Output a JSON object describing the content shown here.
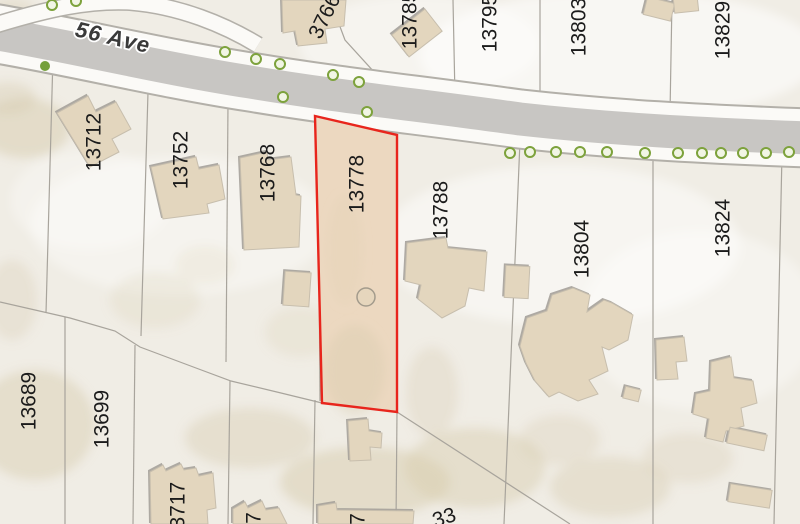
{
  "map": {
    "type": "parcel-map",
    "street": {
      "name": "56 Ave"
    },
    "selected_parcel": {
      "number": "13778",
      "outline_color": "#e8251c",
      "fill_color": "#ecd8c0"
    },
    "labels": [
      {
        "id": "street-56-ave",
        "text": "56 Ave",
        "x": 113,
        "y": 37,
        "rot": 13,
        "kind": "street"
      },
      {
        "id": "3766",
        "text": "3766",
        "x": 324,
        "y": 16,
        "rot": -64,
        "kind": "parcel"
      },
      {
        "id": "13785",
        "text": "13785",
        "x": 409,
        "y": 20,
        "rot": -90,
        "kind": "parcel"
      },
      {
        "id": "13795",
        "text": "13795",
        "x": 489,
        "y": 23,
        "rot": -90,
        "kind": "parcel"
      },
      {
        "id": "13803",
        "text": "13803",
        "x": 578,
        "y": 27,
        "rot": -90,
        "kind": "parcel"
      },
      {
        "id": "13829",
        "text": "13829",
        "x": 722,
        "y": 30,
        "rot": -90,
        "kind": "parcel"
      },
      {
        "id": "13712",
        "text": "13712",
        "x": 93,
        "y": 142,
        "rot": -90,
        "kind": "parcel"
      },
      {
        "id": "13752",
        "text": "13752",
        "x": 180,
        "y": 160,
        "rot": -90,
        "kind": "parcel"
      },
      {
        "id": "13768",
        "text": "13768",
        "x": 267,
        "y": 173,
        "rot": -90,
        "kind": "parcel"
      },
      {
        "id": "13778",
        "text": "13778",
        "x": 356,
        "y": 184,
        "rot": -90,
        "kind": "parcel",
        "selected": true
      },
      {
        "id": "13788",
        "text": "13788",
        "x": 440,
        "y": 210,
        "rot": -90,
        "kind": "parcel"
      },
      {
        "id": "13804",
        "text": "13804",
        "x": 581,
        "y": 249,
        "rot": -90,
        "kind": "parcel"
      },
      {
        "id": "13824",
        "text": "13824",
        "x": 722,
        "y": 228,
        "rot": -90,
        "kind": "parcel"
      },
      {
        "id": "13689",
        "text": "13689",
        "x": 28,
        "y": 401,
        "rot": -90,
        "kind": "parcel"
      },
      {
        "id": "13699",
        "text": "13699",
        "x": 101,
        "y": 419,
        "rot": -90,
        "kind": "parcel"
      },
      {
        "id": "13717",
        "text": "13717",
        "x": 177,
        "y": 511,
        "rot": -90,
        "kind": "parcel"
      },
      {
        "id": "partial-7-left",
        "text": "7",
        "x": 253,
        "y": 518,
        "rot": -90,
        "kind": "parcel"
      },
      {
        "id": "partial-7-mid",
        "text": "7",
        "x": 357,
        "y": 519,
        "rot": -90,
        "kind": "parcel"
      },
      {
        "id": "partial-33",
        "text": "33",
        "x": 444,
        "y": 517,
        "rot": -18,
        "kind": "parcel"
      }
    ],
    "trees": {
      "outlined": [
        [
          52,
          5
        ],
        [
          76,
          1
        ],
        [
          225,
          52
        ],
        [
          256,
          59
        ],
        [
          280,
          64
        ],
        [
          333,
          75
        ],
        [
          359,
          82
        ],
        [
          283,
          97
        ],
        [
          367,
          112
        ],
        [
          510,
          153
        ],
        [
          530,
          152
        ],
        [
          556,
          152
        ],
        [
          580,
          152
        ],
        [
          607,
          152
        ],
        [
          645,
          153
        ],
        [
          678,
          153
        ],
        [
          702,
          153
        ],
        [
          721,
          153
        ],
        [
          743,
          153
        ],
        [
          766,
          153
        ],
        [
          789,
          152
        ]
      ],
      "solid": [
        [
          45,
          66
        ]
      ]
    },
    "colors": {
      "background": "#f0ede5",
      "road_asphalt": "#c8c6c3",
      "sidewalk": "#fbfaf7",
      "road_casing": "#b3b0a9",
      "parcel_line": "#a8a49c",
      "building": "#e3d6be",
      "selected_fill": "#ecd8c0",
      "selected_outline": "#e8251c",
      "tree_green": "#7da23c",
      "label_color": "#1b1b1b"
    }
  }
}
